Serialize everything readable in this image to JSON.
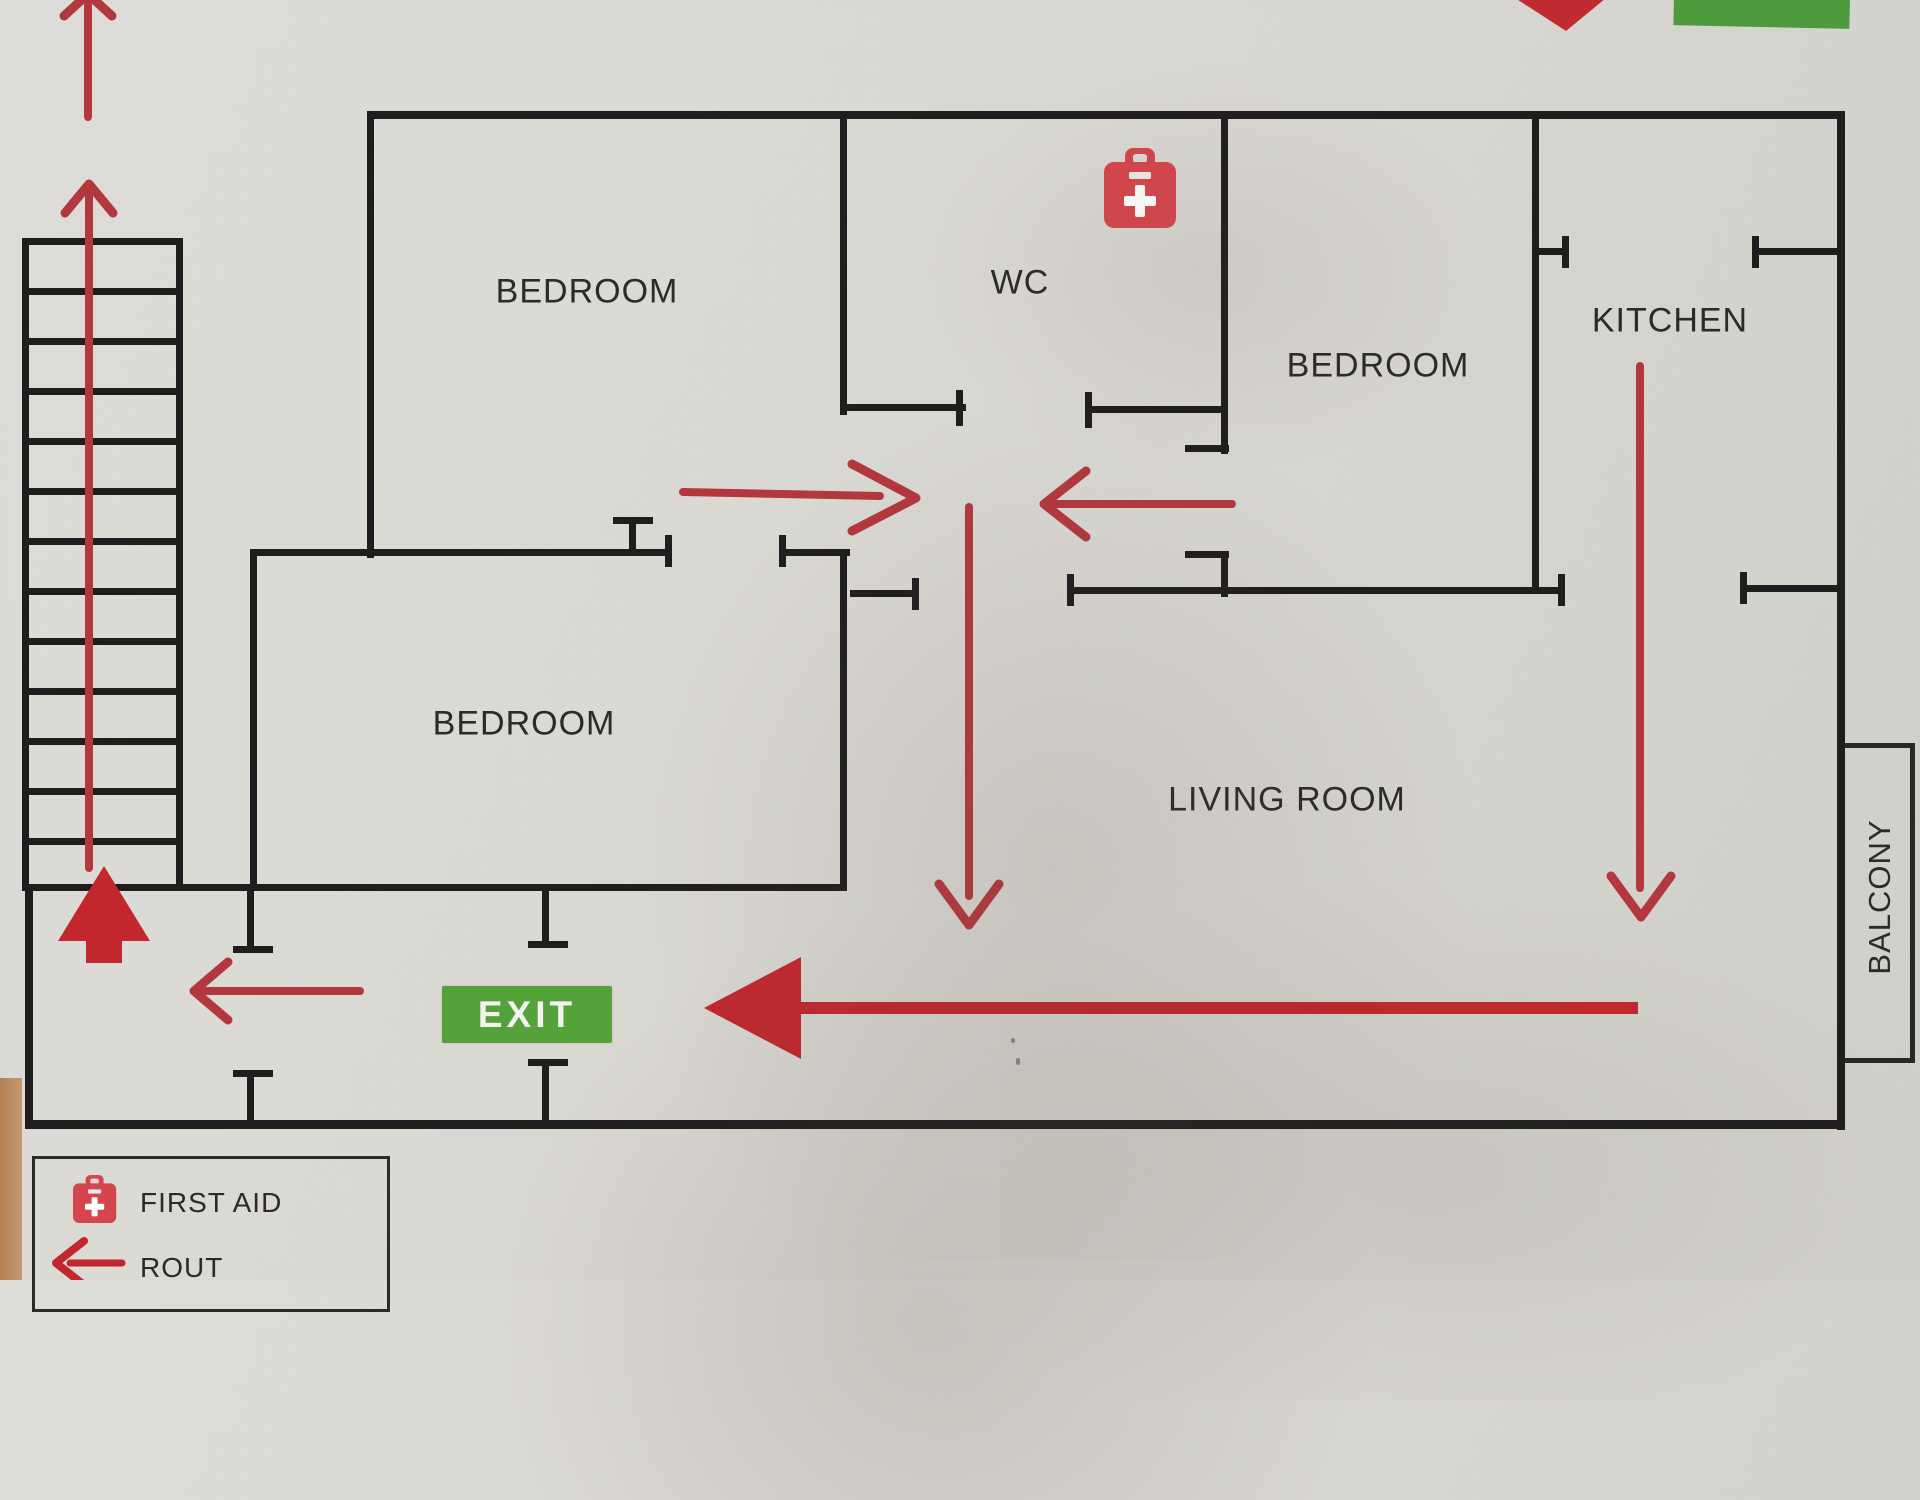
{
  "plan": {
    "labels": {
      "bedroom_top_left": "BEDROOM",
      "wc": "WC",
      "bedroom_right": "BEDROOM",
      "kitchen": "KITCHEN",
      "bedroom_bottom_left": "BEDROOM",
      "living_room": "LIVING ROOM",
      "balcony": "BALCONY"
    },
    "exit_sign": "EXIT",
    "icons": {
      "first_aid": "first-aid-kit-icon",
      "route": "route-arrow-icon"
    },
    "colors": {
      "wall_black": "#1f1d1e",
      "route_red": "#b2383d",
      "solid_arrow_red": "#c1272d",
      "first_aid_red": "#d5464c",
      "exit_green": "#55a23b",
      "paper_background": "#dad8d3"
    }
  },
  "legend": {
    "items": [
      {
        "icon": "first-aid-kit-icon",
        "label": "FIRST AID"
      },
      {
        "icon": "route-arrow-icon",
        "label": "ROUT"
      }
    ]
  }
}
